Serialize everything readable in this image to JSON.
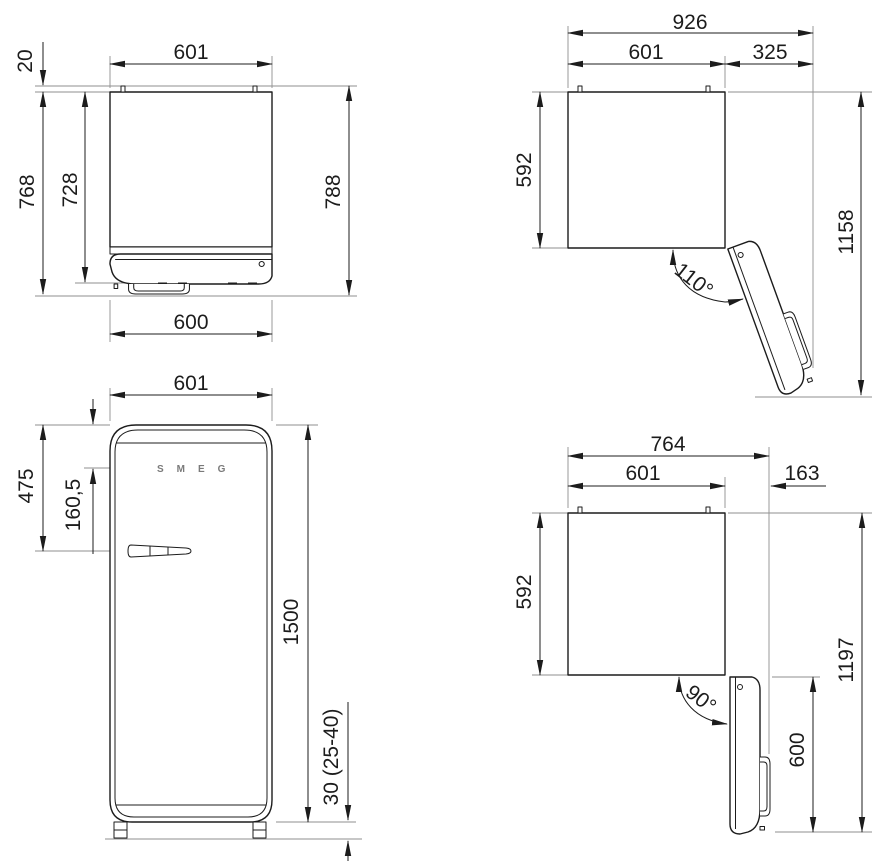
{
  "drawing": {
    "views": {
      "top_closed": {
        "dims": {
          "width_top": "601",
          "rear_spacer": "20",
          "depth_excl_handle": "728",
          "depth_incl_handle": "768",
          "depth_overall": "788",
          "width_front": "600"
        }
      },
      "open_110": {
        "dims": {
          "overall_width": "926",
          "body_width": "601",
          "door_projection": "325",
          "body_depth": "592",
          "overall_depth": "1158",
          "opening_angle": "110°"
        }
      },
      "front": {
        "logo": "SMEG",
        "dims": {
          "width": "601",
          "handle_from_top": "475",
          "logo_from_top": "160,5",
          "height": "1500",
          "feet_height": "30 (25-40)"
        }
      },
      "open_90": {
        "dims": {
          "overall_width": "764",
          "body_width": "601",
          "door_projection": "163",
          "body_depth": "592",
          "overall_depth": "1197",
          "door_width": "600",
          "opening_angle": "90°"
        }
      }
    },
    "colors": {
      "line": "#1c1c1c",
      "thin": "#8f8f8f",
      "background": "#ffffff",
      "logo": "#7a7a7a"
    }
  }
}
